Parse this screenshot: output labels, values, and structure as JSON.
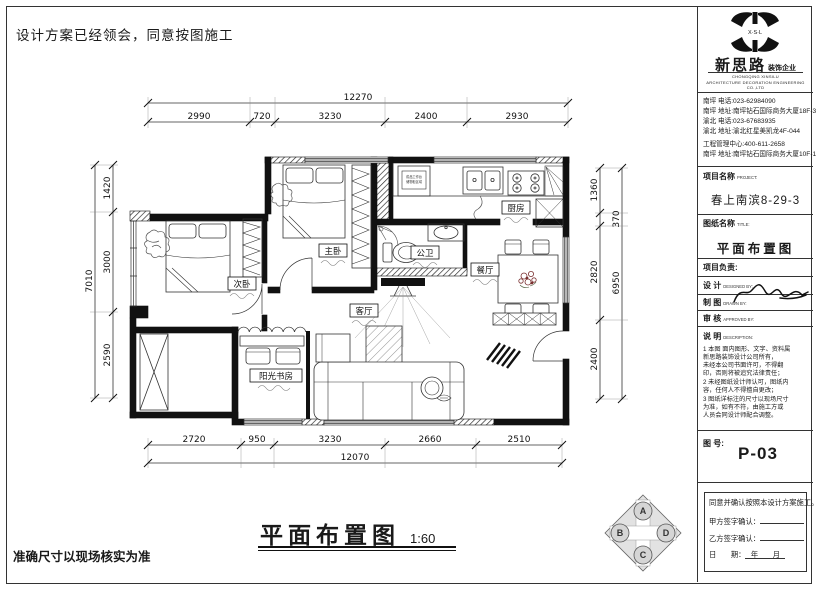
{
  "page": {
    "top_note": "设计方案已经领会，同意按图施工",
    "bottom_note": "准确尺寸以现场核实为准",
    "title": "平面布置图",
    "scale": "1:60"
  },
  "plan": {
    "rooms": {
      "master": "主卧",
      "second": "次卧",
      "kitchen": "厨房",
      "bath": "公卫",
      "dining": "餐厅",
      "living": "客厅",
      "study": "阳光书房"
    },
    "kitchen_note_1": "成品工作台",
    "kitchen_note_2": "储物柜区域",
    "dims": {
      "top": {
        "overall": "12270",
        "segs": [
          "2990",
          "720",
          "3230",
          "2400",
          "2930"
        ]
      },
      "bottom": {
        "overall": "12070",
        "segs": [
          "2720",
          "950",
          "3230",
          "2660",
          "2510"
        ]
      },
      "left": {
        "overall": "7010",
        "segs": [
          "1420",
          "3000",
          "2590"
        ]
      },
      "right": {
        "overall": "6950",
        "segs": [
          "1360",
          "370",
          "2820",
          "2400"
        ]
      }
    }
  },
  "compass": {
    "a": "A",
    "b": "B",
    "c": "C",
    "d": "D"
  },
  "titleblock": {
    "logo_text": "X·S·L",
    "company": "新思路",
    "company_suffix": "装饰企业",
    "company_en1": "CHONGQING XINSILU",
    "company_en2": "ARCHITECTURE DECORATION ENGINEERING CO.,LTD",
    "contacts": [
      "南坪 电话:023-62984090",
      "南坪 地址:南坪钻石国际商务大厦18F-3",
      "渝北 电话:023-67683935",
      "渝北 地址:渝北红星美凯龙4F-044",
      "工程管理中心:400-611-2658",
      "南坪 地址:南坪钻石国际商务大厦10F-1"
    ],
    "project_label": "项目名称",
    "project_label_en": "PROJECT:",
    "project_name": "春上南滨8-29-3",
    "sheet_label": "图纸名称",
    "sheet_label_en": "TITLE:",
    "sheet_name": "平面布置图",
    "lead_label": "项目负责:",
    "design_label": "设 计",
    "design_en": "DESIGNED BY:",
    "draw_label": "制 图",
    "draw_en": "DRAWN BY:",
    "approve_label": "审 核",
    "approve_en": "APPROVED BY:",
    "desc_label": "说 明",
    "desc_en": "DESCRIPTION:",
    "notes": [
      "1 本图 面内图形、文字、资料属",
      "  新思路装饰设计公司所有，",
      "  未经本公司书面许可，不得翻",
      "  印，否则将被追究法律责任；",
      "2 未经图纸设计师认可，图纸内",
      "  容，任何人不得擅自更改；",
      "3 图纸详标注的尺寸以现场尺寸",
      "  为准，如有不符，由施工方或",
      "  人员会同设计师配合调整。"
    ],
    "no_label": "图 号:",
    "no_value": "P-03",
    "confirm_title": "同意并确认按照本设计方案施工。",
    "party_a": "甲方签字确认：",
    "party_b": "乙方签字确认：",
    "date_label": "日　　期：",
    "date_value": "年　　月"
  }
}
